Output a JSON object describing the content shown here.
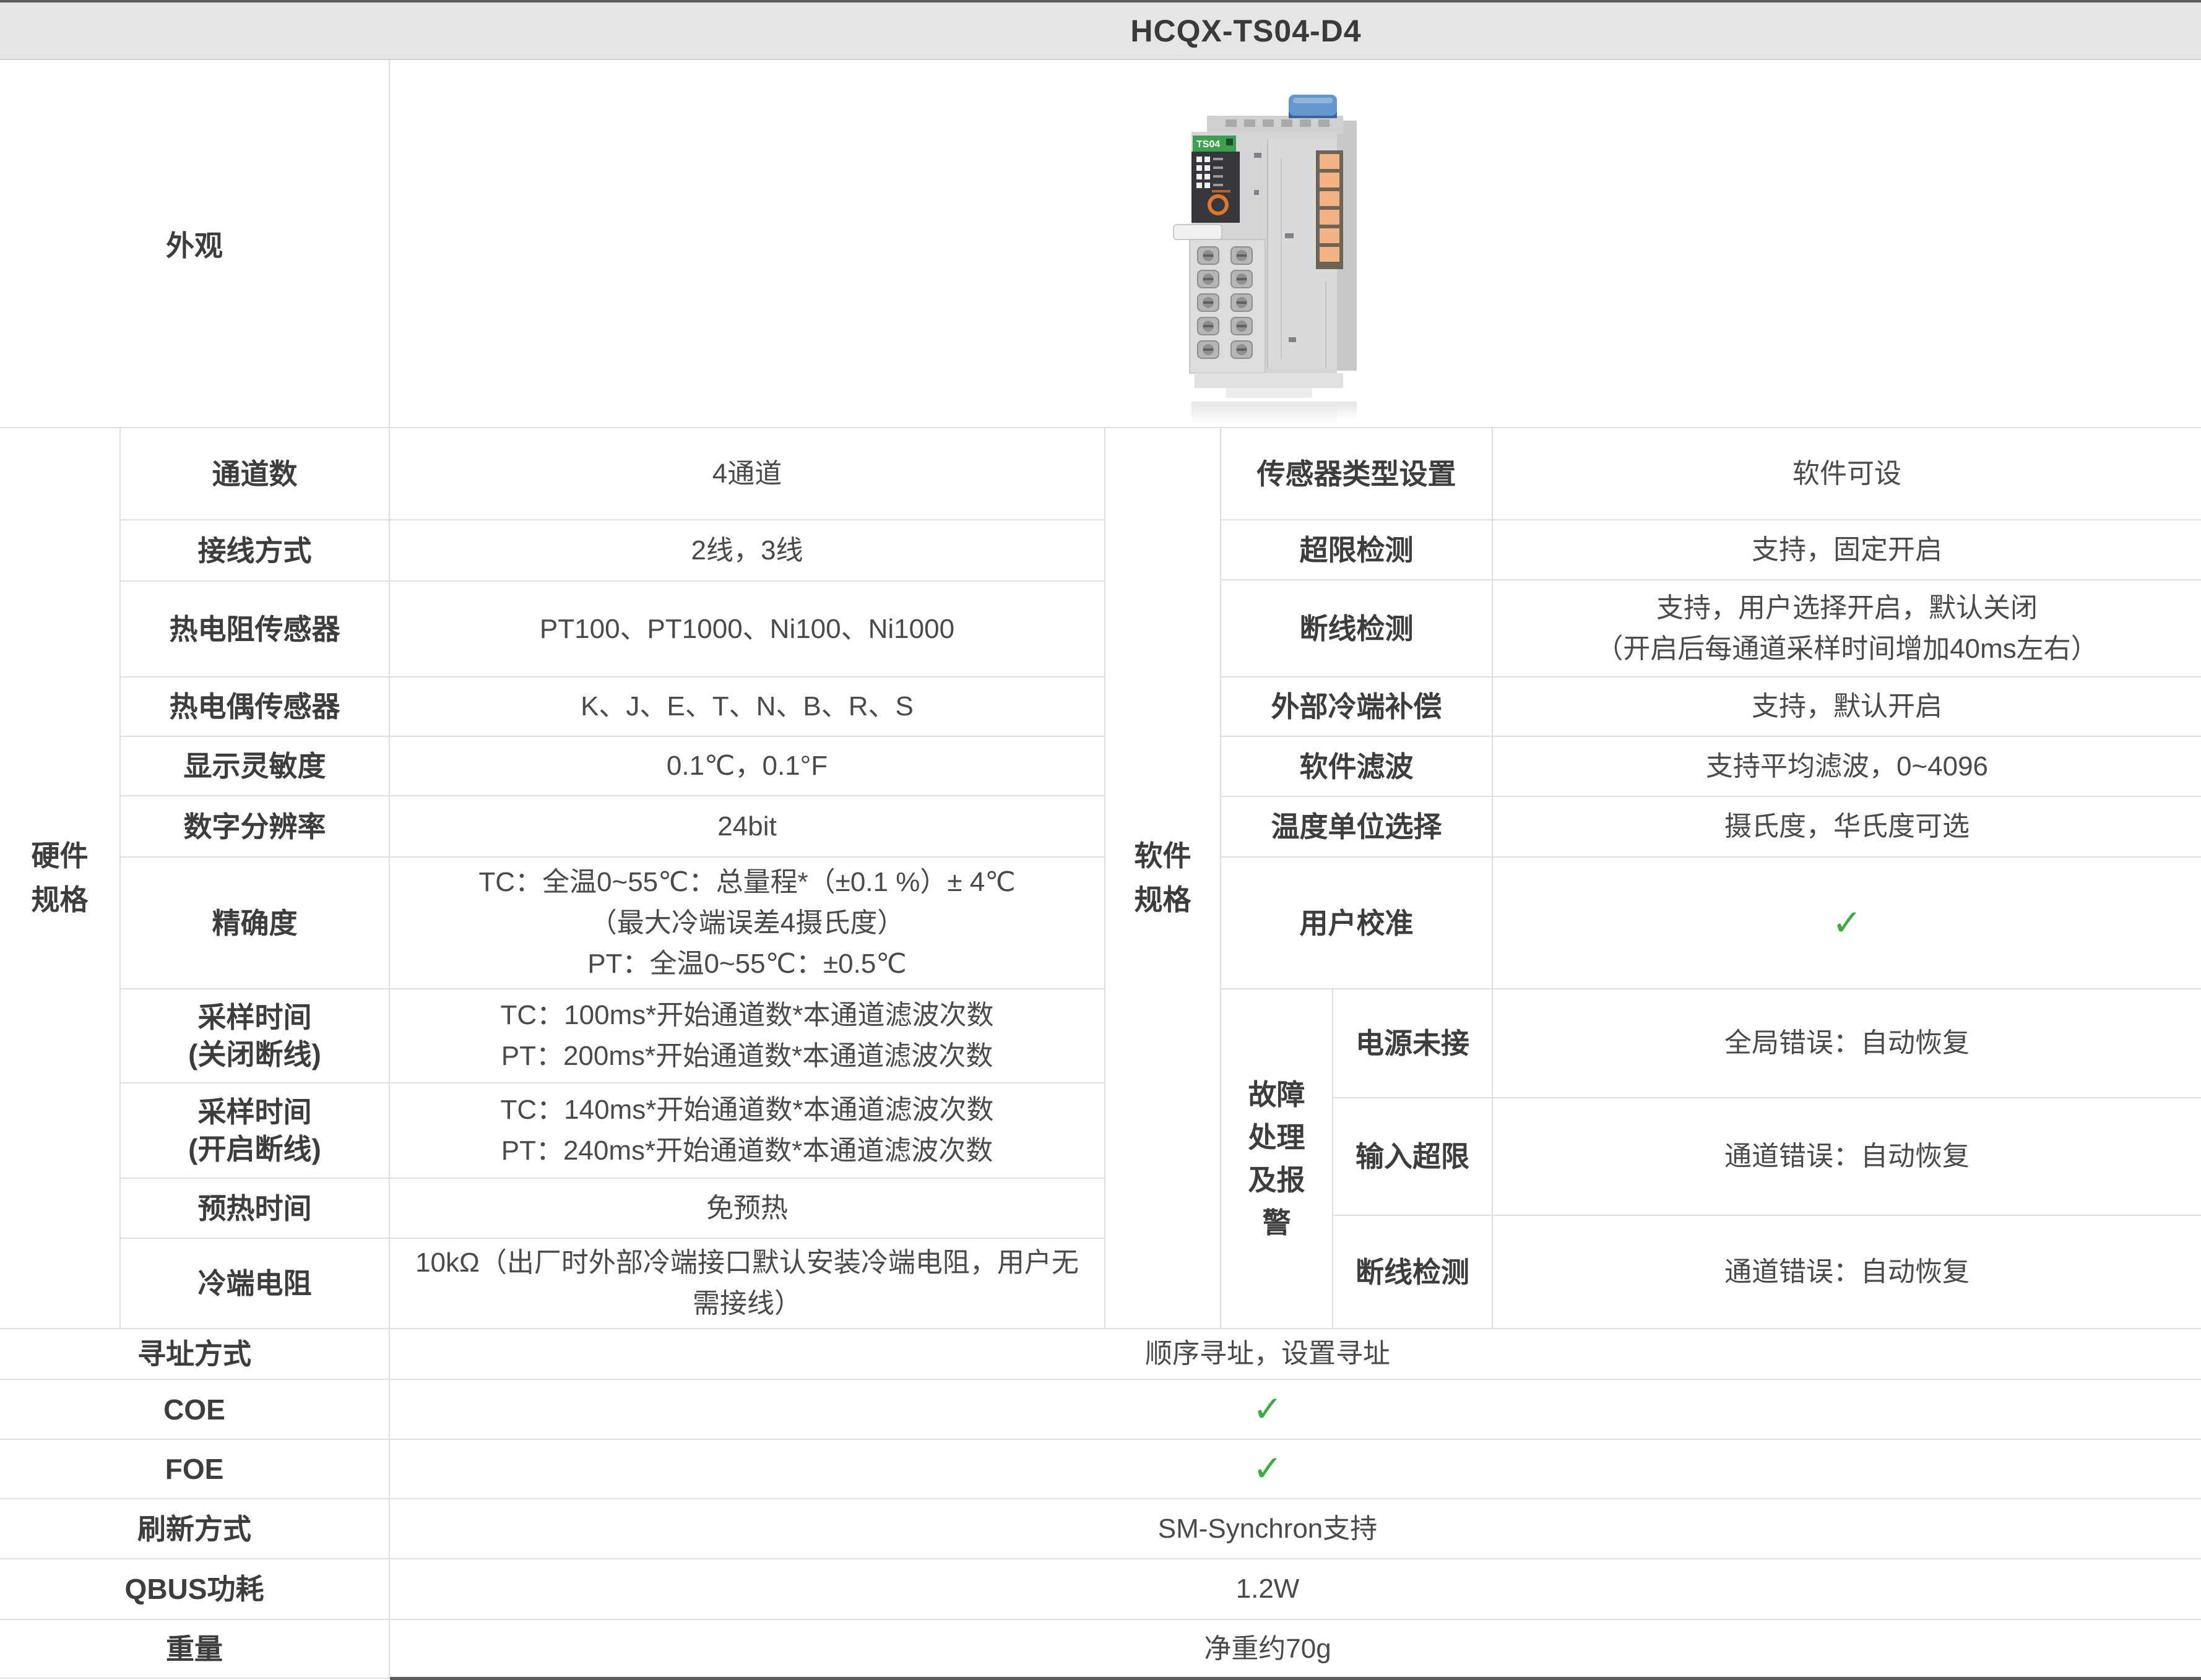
{
  "colors": {
    "accent_green": "#3BAD43",
    "header_bg": "#e5e5e5",
    "grid_line": "#dfdfdf",
    "dark_strip": "#5c5c5e",
    "label_text": "#3d3d3d",
    "value_text": "#4a4a4a"
  },
  "icons": {
    "check": "✓"
  },
  "header": {
    "title": "HCQX-TS04-D4"
  },
  "appearance": {
    "label": "外观"
  },
  "hardware": {
    "section_label": "硬件规格",
    "rows": [
      {
        "label": "通道数",
        "value": "4通道"
      },
      {
        "label": "接线方式",
        "value": "2线，3线"
      },
      {
        "label": "热电阻传感器",
        "value": "PT100、PT1000、Ni100、Ni1000"
      },
      {
        "label": "热电偶传感器",
        "value": "K、J、E、T、N、B、R、S"
      },
      {
        "label": "显示灵敏度",
        "value": "0.1℃，0.1°F"
      },
      {
        "label": "数字分辨率",
        "value": "24bit"
      },
      {
        "label": "精确度",
        "line1": "TC：全温0~55℃：总量程*（±0.1 %）± 4℃",
        "line2": "（最大冷端误差4摄氏度）",
        "line3": "PT：全温0~55℃：±0.5℃"
      },
      {
        "label": "采样时间",
        "label2": "(关闭断线)",
        "line1": "TC：100ms*开始通道数*本通道滤波次数",
        "line2": "PT：200ms*开始通道数*本通道滤波次数"
      },
      {
        "label": "采样时间",
        "label2": "(开启断线)",
        "line1": "TC：140ms*开始通道数*本通道滤波次数",
        "line2": "PT：240ms*开始通道数*本通道滤波次数"
      },
      {
        "label": "预热时间",
        "value": "免预热"
      },
      {
        "label": "冷端电阻",
        "value": "10kΩ（出厂时外部冷端接口默认安装冷端电阻，用户无需接线）"
      }
    ]
  },
  "software": {
    "section_label": "软件规格",
    "rows": [
      {
        "label": "传感器类型设置",
        "value": "软件可设"
      },
      {
        "label": "超限检测",
        "value": "支持，固定开启"
      },
      {
        "label": "断线检测",
        "line1": "支持，用户选择开启，默认关闭",
        "line2": "（开启后每通道采样时间增加40ms左右）"
      },
      {
        "label": "外部冷端补偿",
        "value": "支持，默认开启"
      },
      {
        "label": "软件滤波",
        "value": "支持平均滤波，0~4096"
      },
      {
        "label": "温度单位选择",
        "value": "摄氏度，华氏度可选"
      },
      {
        "label": "用户校准",
        "value": "✓"
      }
    ],
    "fault": {
      "section_label": "故障处理及报警",
      "rows": [
        {
          "label": "电源未接",
          "value": "全局错误：自动恢复"
        },
        {
          "label": "输入超限",
          "value": "通道错误：自动恢复"
        },
        {
          "label": "断线检测",
          "value": "通道错误：自动恢复"
        }
      ]
    }
  },
  "general": {
    "rows": [
      {
        "label": "寻址方式",
        "value": "顺序寻址，设置寻址"
      },
      {
        "label": "COE",
        "value": "✓"
      },
      {
        "label": "FOE",
        "value": "✓"
      },
      {
        "label": "刷新方式",
        "value": "SM-Synchron支持"
      },
      {
        "label": "QBUS功耗",
        "value": "1.2W"
      },
      {
        "label": "重量",
        "value": "净重约70g"
      }
    ]
  }
}
